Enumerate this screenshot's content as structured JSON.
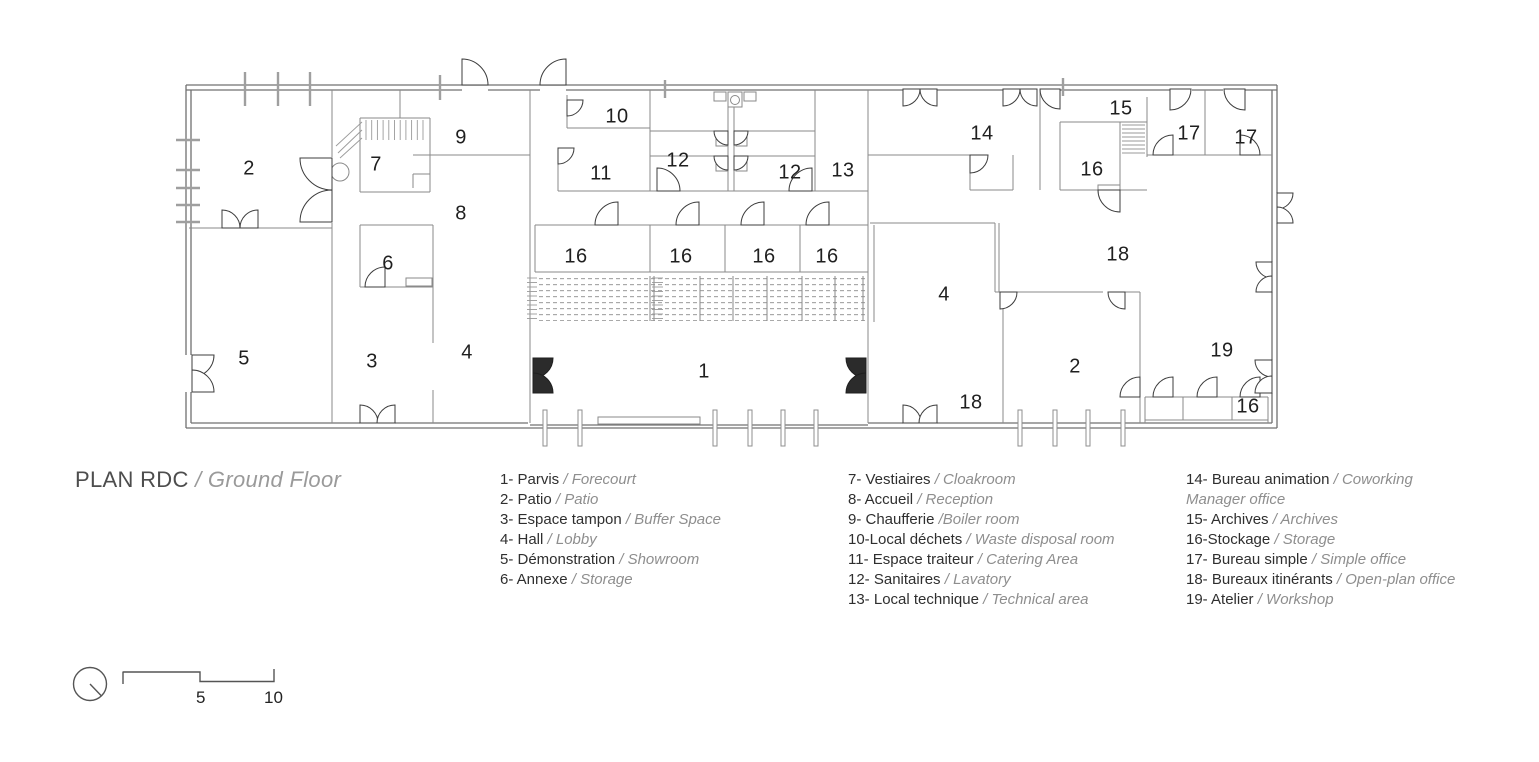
{
  "title": {
    "main": "PLAN RDC",
    "separator": " / ",
    "sub": "Ground Floor"
  },
  "legend": {
    "columns": [
      {
        "items": [
          {
            "fr": "1- Parvis",
            "sep": " / ",
            "en": "Forecourt"
          },
          {
            "fr": "2- Patio",
            "sep": " / ",
            "en": "Patio"
          },
          {
            "fr": "3- Espace tampon",
            "sep": " / ",
            "en": "Buffer Space"
          },
          {
            "fr": "4- Hall",
            "sep": " / ",
            "en": "Lobby"
          },
          {
            "fr": "5- Démonstration",
            "sep": " / ",
            "en": "Showroom"
          },
          {
            "fr": "6- Annexe",
            "sep": " / ",
            "en": "Storage"
          }
        ]
      },
      {
        "items": [
          {
            "fr": "7- Vestiaires",
            "sep": " / ",
            "en": "Cloakroom"
          },
          {
            "fr": "8- Accueil",
            "sep": " / ",
            "en": "Reception"
          },
          {
            "fr": "9- Chaufferie",
            "sep": " /",
            "en": "Boiler room"
          },
          {
            "fr": "10-Local déchets",
            "sep": " / ",
            "en": "Waste disposal room"
          },
          {
            "fr": "11- Espace traiteur",
            "sep": " / ",
            "en": "Catering Area"
          },
          {
            "fr": "12- Sanitaires",
            "sep": " / ",
            "en": "Lavatory"
          },
          {
            "fr": "13- Local technique",
            "sep": " / ",
            "en": "Technical area"
          }
        ]
      },
      {
        "items": [
          {
            "fr": "14- Bureau animation",
            "sep": " / ",
            "en": "Coworking\nManager office"
          },
          {
            "fr": "15- Archives",
            "sep": " / ",
            "en": "Archives"
          },
          {
            "fr": "16-Stockage",
            "sep": " / ",
            "en": "Storage"
          },
          {
            "fr": "17- Bureau simple",
            "sep": " / ",
            "en": "Simple office"
          },
          {
            "fr": "18- Bureaux itinérants",
            "sep": " / ",
            "en": "Open-plan office"
          },
          {
            "fr": "19- Atelier",
            "sep": " / ",
            "en": "Workshop"
          }
        ]
      }
    ]
  },
  "plan": {
    "rooms": [
      {
        "n": "2",
        "x": 249,
        "y": 169
      },
      {
        "n": "7",
        "x": 376,
        "y": 165
      },
      {
        "n": "9",
        "x": 461,
        "y": 138
      },
      {
        "n": "8",
        "x": 461,
        "y": 214
      },
      {
        "n": "6",
        "x": 388,
        "y": 264
      },
      {
        "n": "5",
        "x": 244,
        "y": 359
      },
      {
        "n": "3",
        "x": 372,
        "y": 362
      },
      {
        "n": "4",
        "x": 467,
        "y": 353
      },
      {
        "n": "10",
        "x": 617,
        "y": 117
      },
      {
        "n": "11",
        "x": 601,
        "y": 174
      },
      {
        "n": "12",
        "x": 678,
        "y": 161
      },
      {
        "n": "12",
        "x": 790,
        "y": 173
      },
      {
        "n": "13",
        "x": 843,
        "y": 171
      },
      {
        "n": "16",
        "x": 576,
        "y": 257
      },
      {
        "n": "16",
        "x": 681,
        "y": 257
      },
      {
        "n": "16",
        "x": 764,
        "y": 257
      },
      {
        "n": "16",
        "x": 827,
        "y": 257
      },
      {
        "n": "1",
        "x": 704,
        "y": 372
      },
      {
        "n": "14",
        "x": 982,
        "y": 134
      },
      {
        "n": "15",
        "x": 1121,
        "y": 109
      },
      {
        "n": "16",
        "x": 1092,
        "y": 170
      },
      {
        "n": "17",
        "x": 1189,
        "y": 134
      },
      {
        "n": "17",
        "x": 1246,
        "y": 138
      },
      {
        "n": "18",
        "x": 1118,
        "y": 255
      },
      {
        "n": "4",
        "x": 944,
        "y": 295
      },
      {
        "n": "2",
        "x": 1075,
        "y": 367
      },
      {
        "n": "19",
        "x": 1222,
        "y": 351
      },
      {
        "n": "18",
        "x": 971,
        "y": 403
      },
      {
        "n": "16",
        "x": 1248,
        "y": 407
      }
    ]
  },
  "scalebar": {
    "mid_label": "5",
    "end_label": "10"
  },
  "colors": {
    "wall": "#8a8a8a",
    "wall_outer": "#707070",
    "door": "#3c3c3c",
    "door_filled": "#2b2b2b",
    "title_dark": "#4d4d4d",
    "title_gray": "#9a9a9a",
    "legend_fr": "#2f2f2f",
    "legend_en": "#8e8e8e",
    "room_number": "#1f1f1f"
  }
}
